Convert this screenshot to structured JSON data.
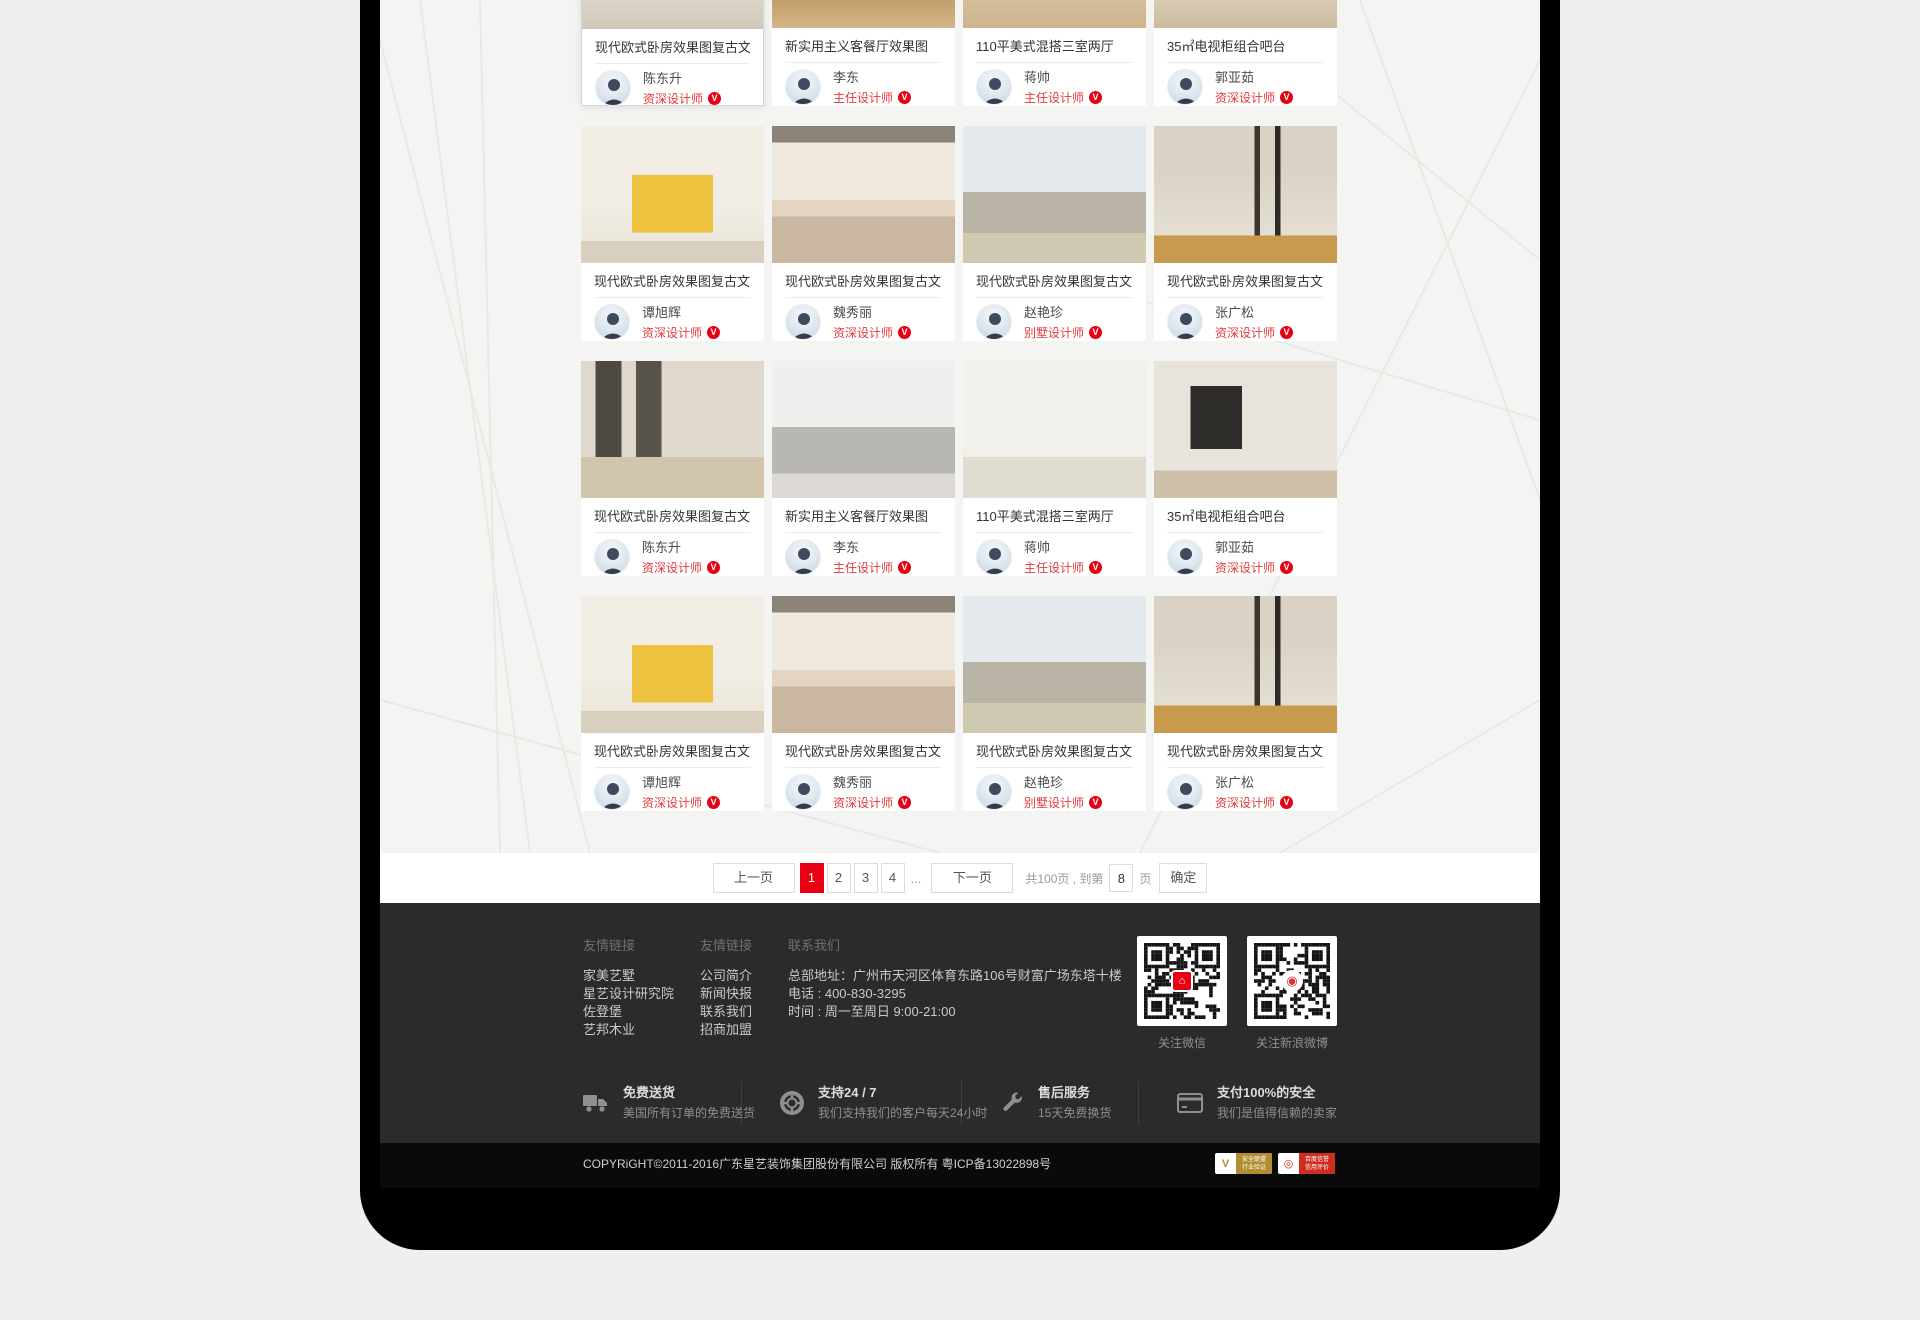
{
  "cards": [
    {
      "title": "现代欧式卧房效果图复古文艺",
      "designer": "陈东升",
      "rank": "资深设计师",
      "photo": "p1",
      "highlighted": true
    },
    {
      "title": "新实用主义客餐厅效果图",
      "designer": "李东",
      "rank": "主任设计师",
      "photo": "p2",
      "highlighted": false
    },
    {
      "title": "110平美式混搭三室两厅",
      "designer": "蒋帅",
      "rank": "主任设计师",
      "photo": "p3",
      "highlighted": false
    },
    {
      "title": "35㎡电视柜组合吧台",
      "designer": "郭亚茹",
      "rank": "资深设计师",
      "photo": "p4",
      "highlighted": false
    },
    {
      "title": "现代欧式卧房效果图复古文艺",
      "designer": "谭旭辉",
      "rank": "资深设计师",
      "photo": "p5",
      "highlighted": false
    },
    {
      "title": "现代欧式卧房效果图复古文艺",
      "designer": "魏秀丽",
      "rank": "资深设计师",
      "photo": "p6",
      "highlighted": false
    },
    {
      "title": "现代欧式卧房效果图复古文艺",
      "designer": "赵艳珍",
      "rank": "别墅设计师",
      "photo": "p7",
      "highlighted": false
    },
    {
      "title": "现代欧式卧房效果图复古文艺",
      "designer": "张广松",
      "rank": "资深设计师",
      "photo": "p8",
      "highlighted": false
    },
    {
      "title": "现代欧式卧房效果图复古文艺",
      "designer": "陈东升",
      "rank": "资深设计师",
      "photo": "p9",
      "highlighted": false
    },
    {
      "title": "新实用主义客餐厅效果图",
      "designer": "李东",
      "rank": "主任设计师",
      "photo": "p10",
      "highlighted": false
    },
    {
      "title": "110平美式混搭三室两厅",
      "designer": "蒋帅",
      "rank": "主任设计师",
      "photo": "p11",
      "highlighted": false
    },
    {
      "title": "35㎡电视柜组合吧台",
      "designer": "郭亚茹",
      "rank": "资深设计师",
      "photo": "p12",
      "highlighted": false
    },
    {
      "title": "现代欧式卧房效果图复古文艺",
      "designer": "谭旭辉",
      "rank": "资深设计师",
      "photo": "p5",
      "highlighted": false
    },
    {
      "title": "现代欧式卧房效果图复古文艺",
      "designer": "魏秀丽",
      "rank": "资深设计师",
      "photo": "p6",
      "highlighted": false
    },
    {
      "title": "现代欧式卧房效果图复古文艺",
      "designer": "赵艳珍",
      "rank": "别墅设计师",
      "photo": "p7",
      "highlighted": false
    },
    {
      "title": "现代欧式卧房效果图复古文艺",
      "designer": "张广松",
      "rank": "资深设计师",
      "photo": "p8",
      "highlighted": false
    }
  ],
  "verified_glyph": "V",
  "pagination": {
    "prev": "上一页",
    "pages": [
      "1",
      "2",
      "3",
      "4"
    ],
    "active_page": "1",
    "ellipsis": "...",
    "next": "下一页",
    "total_text": "共100页 , 到第",
    "jump_value": "8",
    "unit_label": "页",
    "confirm": "确定"
  },
  "footer": {
    "link_groups": [
      {
        "heading": "友情链接",
        "links": [
          "家美艺墅",
          "星艺设计研究院",
          "佐登堡",
          "艺邦木业"
        ]
      },
      {
        "heading": "友情链接",
        "links": [
          "公司简介",
          "新闻快报",
          "联系我们",
          "招商加盟"
        ]
      }
    ],
    "contact": {
      "heading": "联系我们",
      "address": "总部地址：广州市天河区体育东路106号财富广场东塔十楼",
      "phone": "电话 : 400-830-3295",
      "hours": "时间 : 周一至周日 9:00-21:00"
    },
    "qr_codes": [
      {
        "label": "关注微信",
        "logo": "wechat-logo"
      },
      {
        "label": "关注新浪微博",
        "logo": "weibo-logo"
      }
    ],
    "services": [
      {
        "title": "免费送货",
        "subtitle": "美国所有订单的免费送货",
        "icon": "truck-icon"
      },
      {
        "title": "支持24 / 7",
        "subtitle": "我们支持我们的客户每天24小时",
        "icon": "lifebuoy-icon"
      },
      {
        "title": "售后服务",
        "subtitle": "15天免费换货",
        "icon": "wrench-icon"
      },
      {
        "title": "支付100%的安全",
        "subtitle": "我们是值得信赖的卖家",
        "icon": "credit-card-icon"
      }
    ],
    "copyright": "COPYRiGHT©2011-2016广东星艺装饰集团股份有限公司 版权所有 粤ICP备13022898号",
    "cert_badges": [
      {
        "line1": "安全联盟",
        "line2": "行业验证",
        "glyph": "V"
      },
      {
        "line1": "百度信誉",
        "line2": "信用评价",
        "glyph": "◎"
      }
    ]
  },
  "colors": {
    "accent": "#e60012",
    "rank_red": "#e4393c",
    "footer_bg": "#2b2b2b",
    "copyright_bg": "#0a0a0a",
    "frame": "#000000",
    "canvas": "#efefef"
  }
}
